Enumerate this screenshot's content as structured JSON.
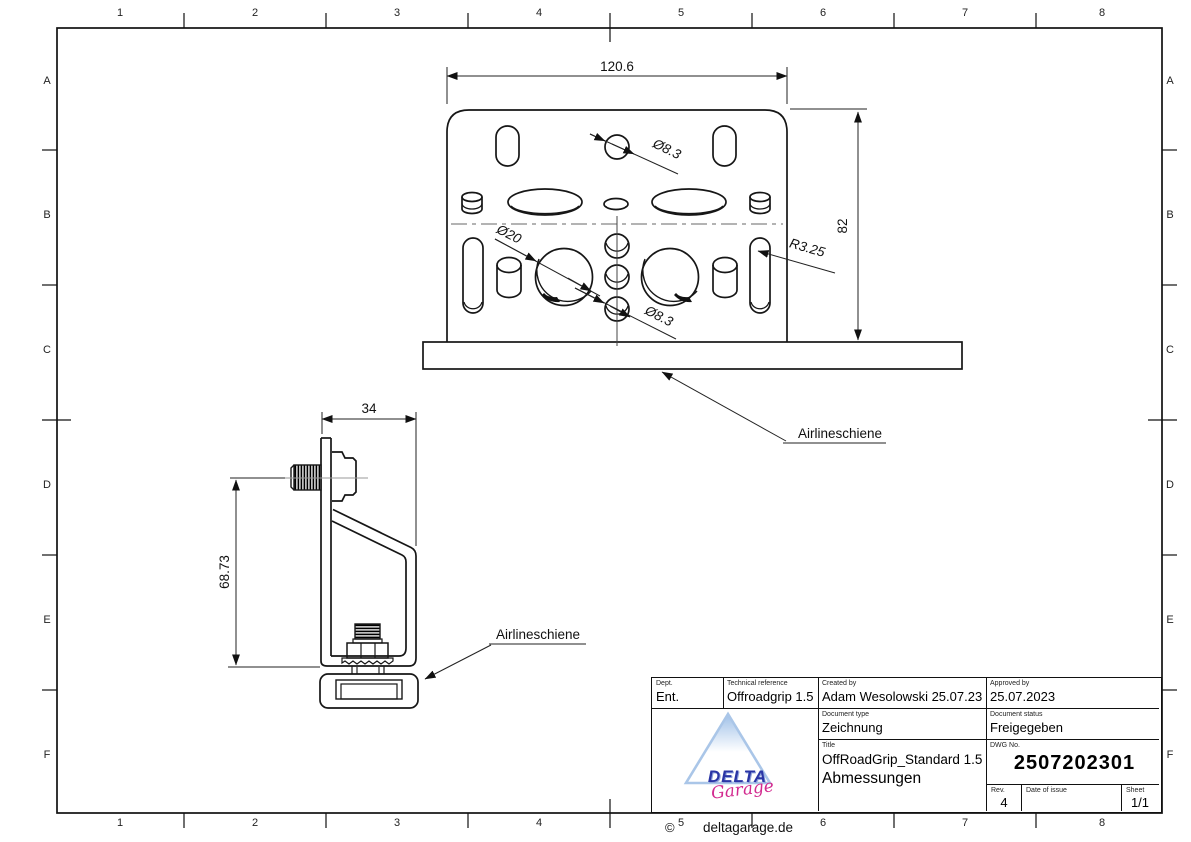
{
  "sheet": {
    "grid": {
      "columns": [
        "1",
        "2",
        "3",
        "4",
        "5",
        "6",
        "7",
        "8"
      ],
      "rows": [
        "A",
        "B",
        "C",
        "D",
        "E",
        "F"
      ]
    }
  },
  "front_view": {
    "width_dim": "120.6",
    "height_dim": "82",
    "top_hole_dim": "Ø8.3",
    "large_hole_dim": "Ø20",
    "slot_radius_dim": "R3.25",
    "bottom_hole_dim": "Ø8.3",
    "rail_label": "Airlineschiene"
  },
  "side_view": {
    "depth_dim": "34",
    "height_dim": "68.73",
    "rail_label": "Airlineschiene"
  },
  "title_block": {
    "dept": {
      "label": "Dept.",
      "value": "Ent."
    },
    "technical_reference": {
      "label": "Technical reference",
      "value": "Offroadgrip 1.5"
    },
    "created_by": {
      "label": "Created by",
      "value": "Adam Wesolowski 25.07.23"
    },
    "approved_by": {
      "label": "Approved by",
      "value": "25.07.2023"
    },
    "document_type": {
      "label": "Document type",
      "value": "Zeichnung"
    },
    "document_status": {
      "label": "Document status",
      "value": "Freigegeben"
    },
    "title": {
      "label": "Title",
      "line1": "OffRoadGrip_Standard 1.5",
      "line2": "Abmessungen"
    },
    "dwg_no": {
      "label": "DWG No.",
      "value": "2507202301"
    },
    "rev": {
      "label": "Rev.",
      "value": "4"
    },
    "date_of_issue": {
      "label": "Date of issue",
      "value": ""
    },
    "sheet_field": {
      "label": "Sheet",
      "value": "1/1"
    },
    "logo": {
      "brand": "DELTA",
      "script": "Garage",
      "copyright": "©",
      "website": "deltagarage.de"
    }
  },
  "colors": {
    "line": "#161616",
    "centerline": "#9a9a9a",
    "logo_blue": "#2a35a5",
    "logo_triangle": "#aac6e8",
    "logo_pink": "#d22a8f"
  }
}
